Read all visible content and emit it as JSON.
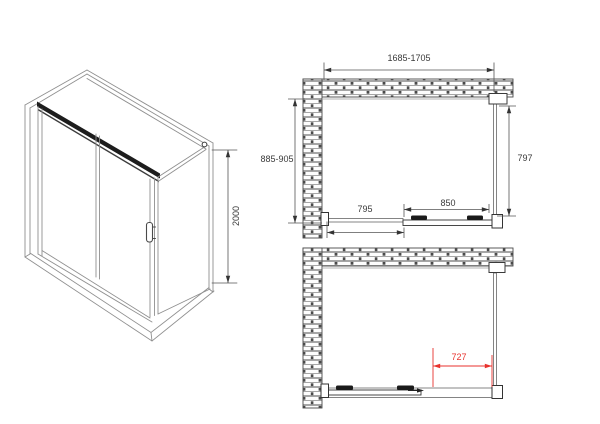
{
  "drawing": {
    "title": "Shower enclosure technical drawing",
    "labels": {
      "height": "2000",
      "overall_width": "1685-1705",
      "overall_depth": "885-905",
      "side_panel": "797",
      "fixed_panel": "795",
      "sliding_door": "850",
      "opening": "727"
    },
    "colors": {
      "line": "#4a4a4a",
      "glass_line": "#909090",
      "dark": "#1a1a1a",
      "highlight_red": "#e8322d",
      "background": "#ffffff"
    }
  }
}
